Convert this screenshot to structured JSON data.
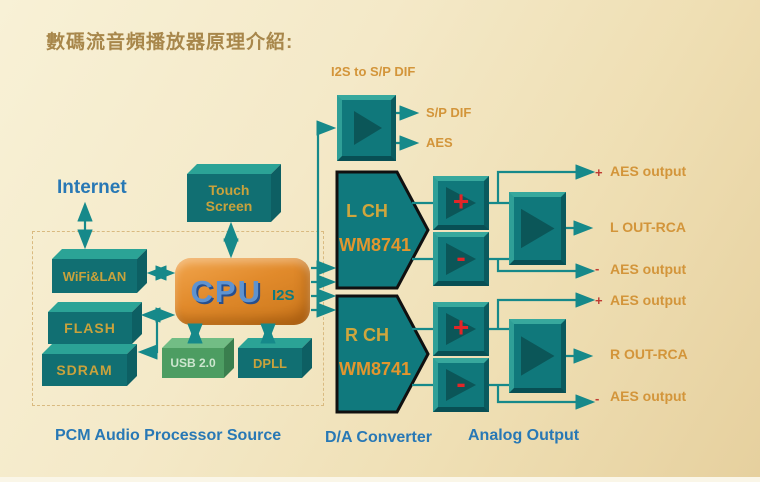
{
  "title": "數碼流音頻播放器原理介紹:",
  "sections": {
    "source_label": "PCM Audio Processor Source",
    "dac_label": "D/A Converter",
    "analog_label": "Analog Output"
  },
  "source": {
    "internet": "Internet",
    "wifi": "WiFi&LAN",
    "flash": "FLASH",
    "sdram": "SDRAM",
    "cpu": "CPU",
    "cpu_bus": "I2S",
    "touch_line1": "Touch",
    "touch_line2": "Screen",
    "usb": "USB 2.0",
    "dpll": "DPLL"
  },
  "converter": {
    "label": "I2S to S/P DIF",
    "out1": "S/P DIF",
    "out2": "AES"
  },
  "dac": {
    "lch_line1": "L CH",
    "lch_line2": "WM8741",
    "rch_line1": "R CH",
    "rch_line2": "WM8741",
    "plus": "+",
    "minus": "-"
  },
  "outputs": {
    "l_aes_plus_sign": "+",
    "l_aes_plus": "AES output",
    "l_rca": "L OUT-RCA",
    "l_aes_minus_sign": "-",
    "l_aes_minus": "AES output",
    "r_aes_plus_sign": "+",
    "r_aes_plus": "AES output",
    "r_rca": "R OUT-RCA",
    "r_aes_minus_sign": "-",
    "r_aes_minus": "AES output"
  },
  "colors": {
    "background": "#f3e8c5",
    "teal": "#116f72",
    "teal_light": "#2ba396",
    "orange_cpu": "#e18a2b",
    "gold_text": "#c9a23c",
    "orange_text": "#d3953a",
    "blue_text": "#2878b5",
    "red_sign": "#e32528",
    "line": "#16898a",
    "green_usb": "#4d9d62"
  }
}
